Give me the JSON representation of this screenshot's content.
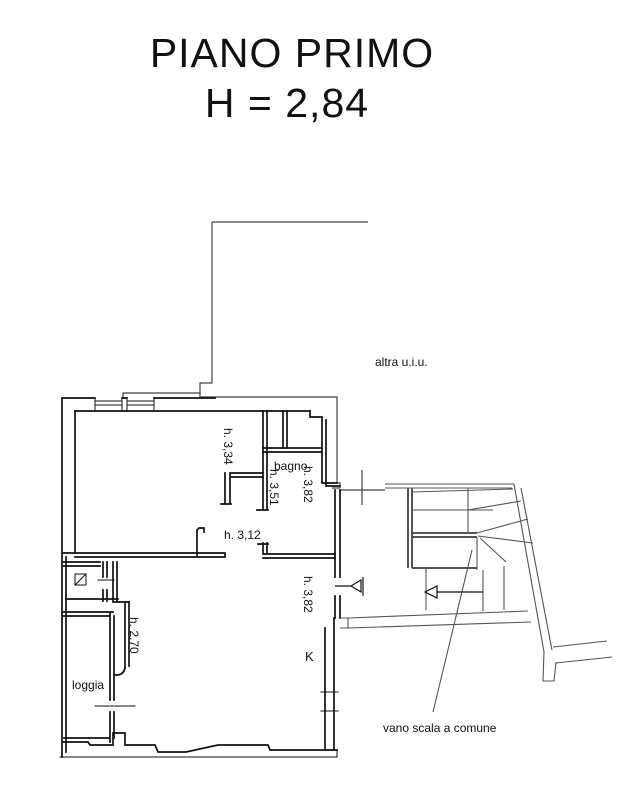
{
  "title": {
    "line1": "PIANO PRIMO",
    "line2": "H = 2,84"
  },
  "labels": {
    "altra_uiu": "altra u.i.u.",
    "h_334": "h. 3,34",
    "bagno": "bagno",
    "h_382_bagno": "h. 3,82",
    "h_351": "h. 3,51",
    "h_312": "h. 3,12",
    "h_382_ingresso": "h. 3,82",
    "kitchen": "K",
    "h_270": "h. 2,70",
    "loggia": "loggia",
    "vano_scala": "vano scala a comune"
  },
  "colors": {
    "ink": "#111111",
    "boundary": "#444444",
    "stair": "#555555",
    "background": "#ffffff"
  }
}
